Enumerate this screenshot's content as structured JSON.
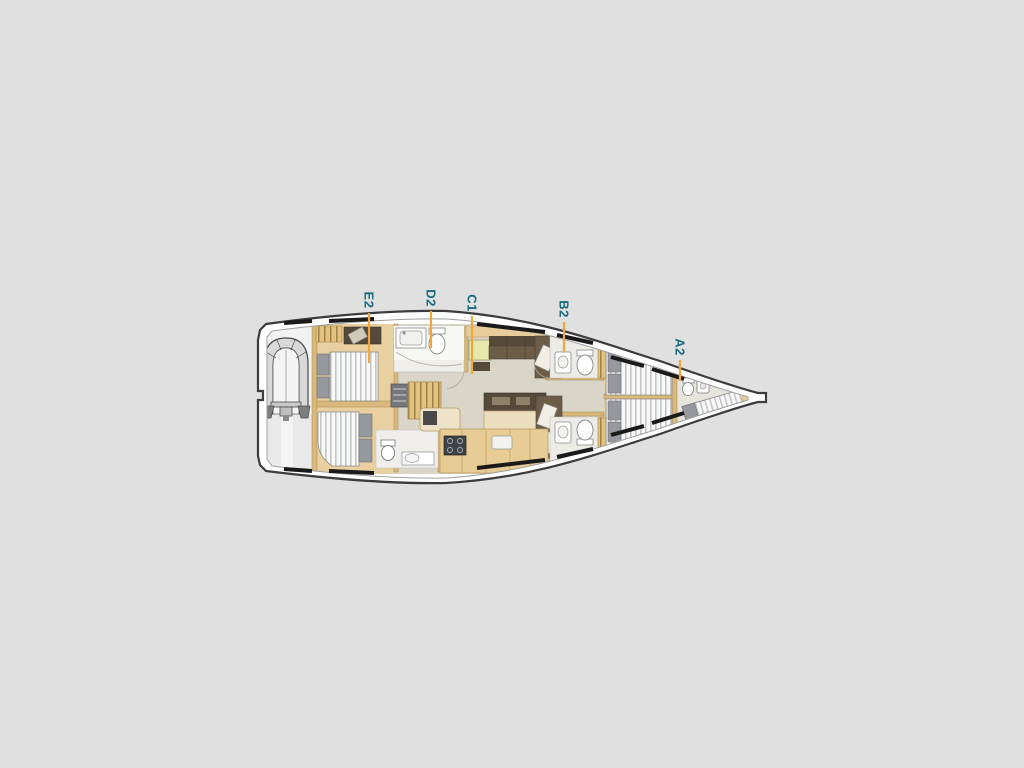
{
  "background_color": "#e0e0e0",
  "plan": {
    "name": "Sailing yacht interior deck layout plan",
    "label_color": "#176a80",
    "leader_color": "#efa73e",
    "labels": [
      {
        "id": "E2",
        "text": "E2"
      },
      {
        "id": "D2",
        "text": "D2"
      },
      {
        "id": "C1",
        "text": "C1"
      },
      {
        "id": "B2",
        "text": "B2"
      },
      {
        "id": "A2",
        "text": "A2"
      }
    ],
    "palette": {
      "hull_fill": "#ffffff",
      "hull_outline": "#3c3c3c",
      "deck_inner_line": "#a0a0a0",
      "wood": "#e9d0a0",
      "wood_dark": "#d8b87b",
      "salon_floor": "#d9d5c9",
      "bathroom_floor": "#efeeea",
      "sofa_dark": "#55493a",
      "sofa": "#6b5d48",
      "mattress": "#f9f9f8",
      "mattress_stripe": "#c2c6ca",
      "pillow_gray": "#95989c",
      "nav_table": "#e6e8ac",
      "counter": "#e7cc96",
      "stove": "#3f4246",
      "hull_window": "#1a1a1a",
      "tender_gray": "#d9d9d9"
    }
  }
}
